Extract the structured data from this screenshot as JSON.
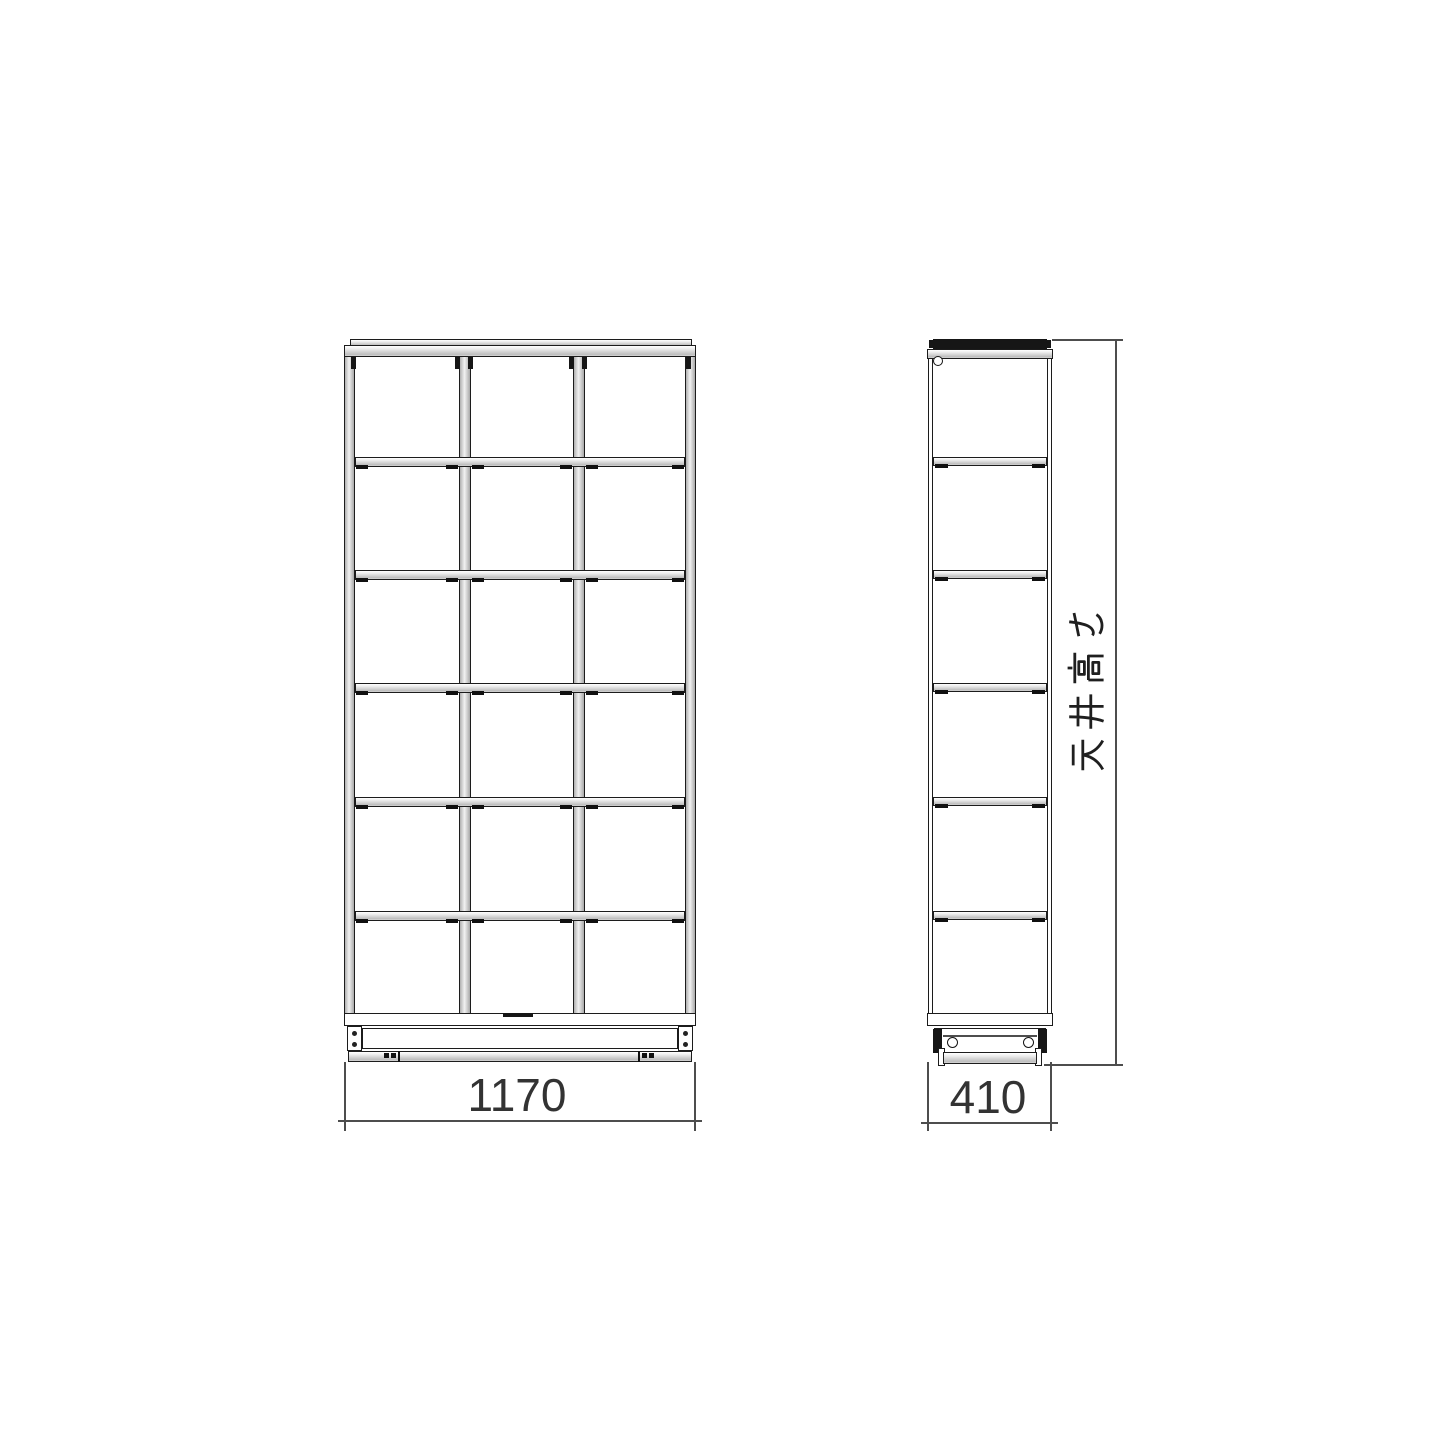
{
  "page": {
    "background": "#ffffff"
  },
  "drawing": {
    "type": "furniture-dimension-diagram",
    "views": {
      "front": {
        "label": "front elevation",
        "columns": 3,
        "rows": 6,
        "compartments": 18,
        "width_dimension": "1170"
      },
      "side": {
        "label": "side elevation",
        "rows": 6,
        "depth_dimension": "410"
      }
    },
    "height_dimension_label": "天井高さ",
    "colors": {
      "line": "#1c1c1c",
      "dimension_line": "#4d4d4d",
      "text": "#333333",
      "shelf_fill_light": "#f2f2f2",
      "shelf_fill_dark": "#bdbdbd",
      "cap_dark": "#161616",
      "background": "#ffffff"
    }
  }
}
